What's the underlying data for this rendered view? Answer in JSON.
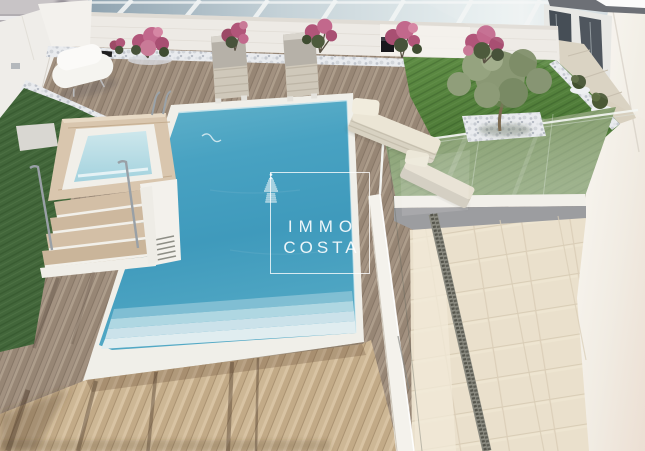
{
  "watermark": {
    "icon": "lighthouse-icon",
    "line1": "IMMO",
    "line2": "COSTA"
  },
  "palette": {
    "pool_water": "#459fc0",
    "pool_shallow_step": "#cfe5ec",
    "jacuzzi_water": "#b5dbe5",
    "deck_wood_dark": "#a29180",
    "deck_wood_tan": "#ccb695",
    "lawn_green": "#55813c",
    "lawn_through_glass": "#7b9465",
    "stone_tile": "#eae0cc",
    "wall_white": "#efece7",
    "pebbles": "#e9ebee",
    "bougainvillea_pink": "#c2688c",
    "glazing_gray_blue": "#aebfc9",
    "drain_gray": "#5a5a52",
    "watermark_white": "#ffffff"
  },
  "regions": [
    "glass-windbreak",
    "perimeter-wall",
    "pebble-border",
    "pool",
    "pool-steps",
    "jacuzzi-platform",
    "jacuzzi-stairs",
    "handrails",
    "sun-loungers-gray",
    "sun-loungers-cream",
    "designer-lounger-white",
    "artificial-lawn",
    "olive-tree",
    "bougainvillea-bushes",
    "glass-balustrade",
    "lower-terrace-tiles",
    "drain-channel",
    "villa-wall",
    "villa-windows",
    "stone-path",
    "wood-deck",
    "tan-deck-shadows"
  ]
}
